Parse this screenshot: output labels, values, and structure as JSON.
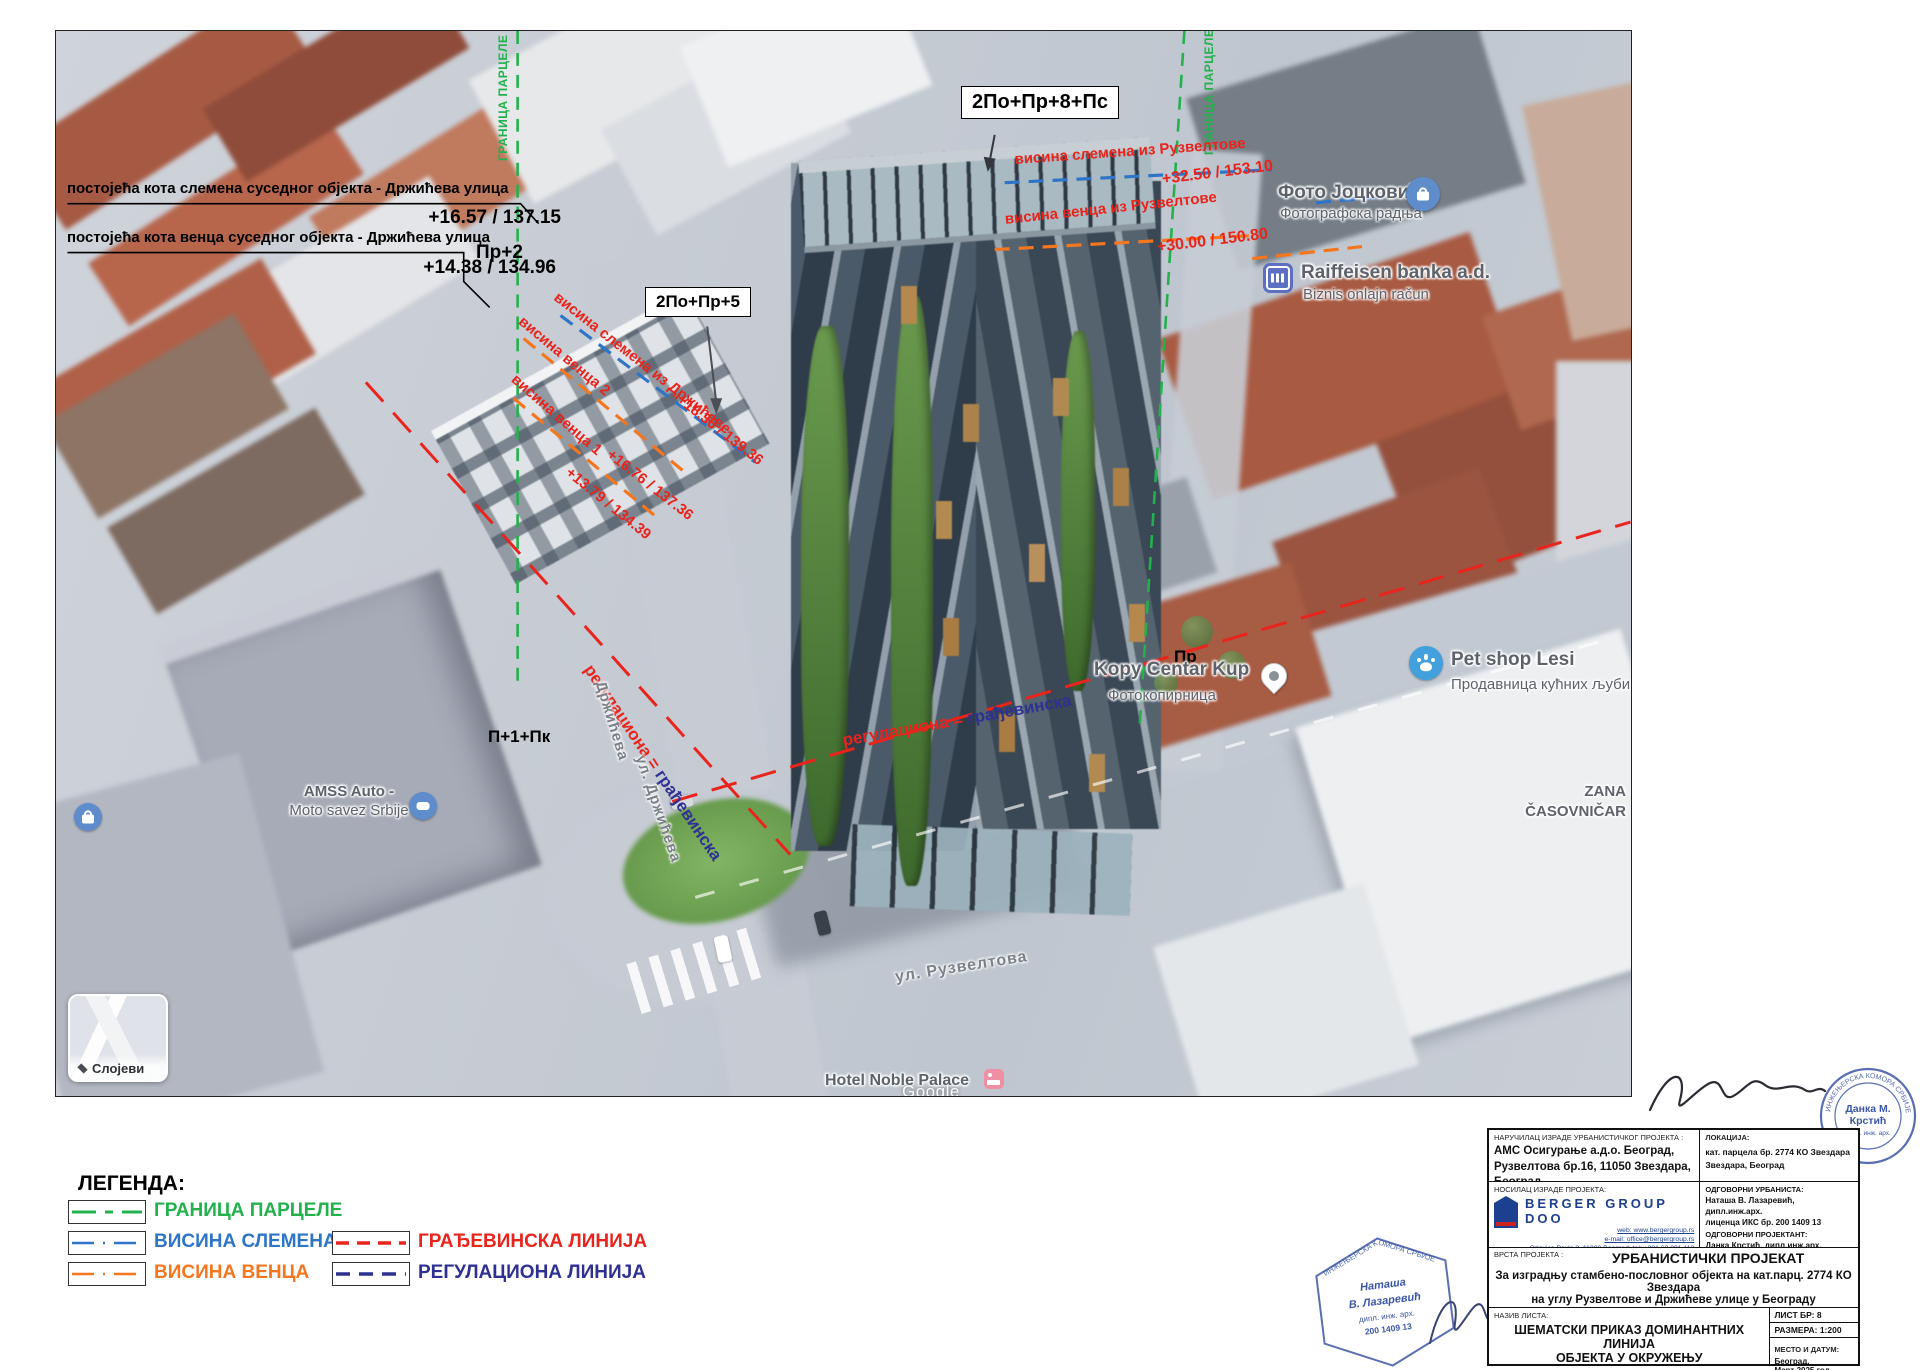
{
  "map": {
    "google_credit": "Google",
    "layers_card": {
      "label": "Слојеви"
    },
    "floors": {
      "tower": "2По+Пр+8+Пс",
      "left_building": "2По+Пр+5",
      "neighbor_drziceva": "Пр+2",
      "corner_small": "П+1+Пк",
      "ruzveltova_small": "Пр"
    },
    "notes": {
      "ridge_note": "постојећа кота слемена суседног објекта - Држићева улица",
      "ridge_value": "+16.57 / 137.15",
      "eaves_note": "постојећа кота венца суседног објекта - Држићева улица",
      "eaves_value": "+14.38 / 134.96"
    },
    "height_lines": {
      "parcel_left": "ГРАНИЦА ПАРЦЕЛЕ",
      "parcel_right": "ГРАНИЦА ПАРЦЕЛЕ",
      "ridge_drziceva": {
        "label": "висина слемена из Држићеве",
        "value": "+18.36 / 139.36"
      },
      "eaves2_drziceva": {
        "label": "висина венца 2",
        "value": "+16.76 / 137.36"
      },
      "eaves1_drziceva": {
        "label": "висина венца 1",
        "value": "+13.79 / 134.39"
      },
      "ridge_ruzveltova": {
        "label": "висина слемена из Рузвелтове",
        "value": "+32.50 / 153.10"
      },
      "eaves_ruzveltova": {
        "label": "висина венца из Рузвелтове",
        "value": "+30.00 / 150.80"
      },
      "reg_build_left": {
        "red": "регулациона = ",
        "blue": "грађевинска"
      },
      "reg_build_bottom": {
        "red": "регулациона = ",
        "blue": "грађевинска"
      }
    },
    "streets": {
      "drziceva_top": "Држићева",
      "drziceva": "ул. Држићева",
      "ruzveltova": "ул. Рузвелтова"
    },
    "poi": {
      "foto": {
        "name": "Фото Јоцковић",
        "sub": "Фотографска радња"
      },
      "raiffeisen": {
        "name": "Raiffeisen banka a.d.",
        "sub": "Biznis onlajn račun"
      },
      "kopy": {
        "name": "Kopy Centar Kup",
        "sub": "Фотокопирница"
      },
      "petshop": {
        "name": "Pet shop Lesi",
        "sub": "Продавница кућних љуби"
      },
      "amss": {
        "name": "AMSS Auto -",
        "sub": "Moto savez Srbije"
      },
      "zana": {
        "name": "ZANA",
        "sub": "ČASOVNIČAR"
      },
      "hotel": {
        "name": "Hotel Noble Palace"
      }
    }
  },
  "legend": {
    "title": "ЛЕГЕНДА:",
    "items": [
      {
        "label": "ГРАНИЦА ПАРЦЕЛЕ",
        "color": "#22b14c",
        "style": "dashdot"
      },
      {
        "label": "ВИСИНА СЛЕМЕНА",
        "color": "#2e75c8",
        "style": "dashdot"
      },
      {
        "label": "ВИСИНА ВЕНЦА",
        "color": "#f4761f",
        "style": "dashdot"
      },
      {
        "label": "ГРАЂЕВИНСКА ЛИНИЈА",
        "color": "#e8241c",
        "style": "dashed"
      },
      {
        "label": "РЕГУЛАЦИОНА ЛИНИЈА",
        "color": "#2e3192",
        "style": "dashed"
      }
    ]
  },
  "title_block": {
    "client_label": "НАРУЧИЛАЦ ИЗРАДЕ УРБАНИСТИЧКОГ ПРОЈЕКТА :",
    "client_line1": "АМС Осигурање а.д.о. Београд,",
    "client_line2": "Рузвелтова бр.16, 11050 Звездара, Београд",
    "location_label": "ЛОКАЦИЈА:",
    "location_line1": "кат. парцела бр. 2774 КО Звездара",
    "location_line2": "Звездара, Београд",
    "author_label": "НОСИЛАЦ ИЗРАДЕ ПРОЈЕКТА:",
    "author_logo": "BERGER GROUP DOO",
    "author_web": "web:  www.bergergroup.rs",
    "author_email": "e-mail:  office@bergergroup.rs",
    "author_addr": "Orlovica Pavla 2, 11000 Beograd; tel: +381 63 291 113",
    "urbanist_label": "ОДГОВОРНИ УРБАНИСТА:",
    "urbanist_name": "Наташа В. Лазаревић, дипл.инж.арх.",
    "urbanist_lic": "лиценца ИКС бр. 200 1409 13",
    "designer_label": "ОДГОВОРНИ ПРОЈЕКТАНТ:",
    "designer_name": "Данка Крстић, дипл.инж.арх.",
    "designer_lic": "лиценца ИКС бр. 321 А08 222",
    "type_label": "ВРСТА ПРОЈЕКТА :",
    "type_title": "УРБАНИСТИЧКИ ПРОЈЕКАТ",
    "type_desc1": "За изградњу стамбено-пословног објекта на кат.парц. 2774 КО Звездара",
    "type_desc2": "на углу Рузвелтове и Држићеве улице у Београду",
    "sheet_label": "НАЗИВ ЛИСТА:",
    "sheet_title1": "ШЕМАТСКИ ПРИКАЗ ДОМИНАНТНИХ ЛИНИЈА",
    "sheet_title2": "ОБЈЕКТА У ОКРУЖЕЊУ",
    "sheet_no": "ЛИСТ БР: 8",
    "scale": "РАЗМЕРА: 1:200",
    "place_label": "МЕСТО И ДАТУМ:",
    "place_line1": "Београд,",
    "place_line2": "Март 2025.год."
  },
  "stamps": {
    "round": {
      "org": "ИНЖЕЊЕРСКА КОМОРА СРБИЈЕ",
      "name1": "Данка М.",
      "name2": "Крстић",
      "title": "дипл. инж. арх."
    },
    "hex": {
      "org": "ИНЖЕЊЕРСКА КОМОРА СРБИЈЕ",
      "name1": "Наташа",
      "name2": "В. Лазаревић",
      "title": "дипл. инж. арх.",
      "number": "200 1409 13"
    }
  },
  "colors": {
    "parcel_green": "#22b14c",
    "ridge_blue": "#2e75c8",
    "eaves_orange": "#f4761f",
    "building_red": "#e8241c",
    "regulation_navy": "#2e3192"
  }
}
